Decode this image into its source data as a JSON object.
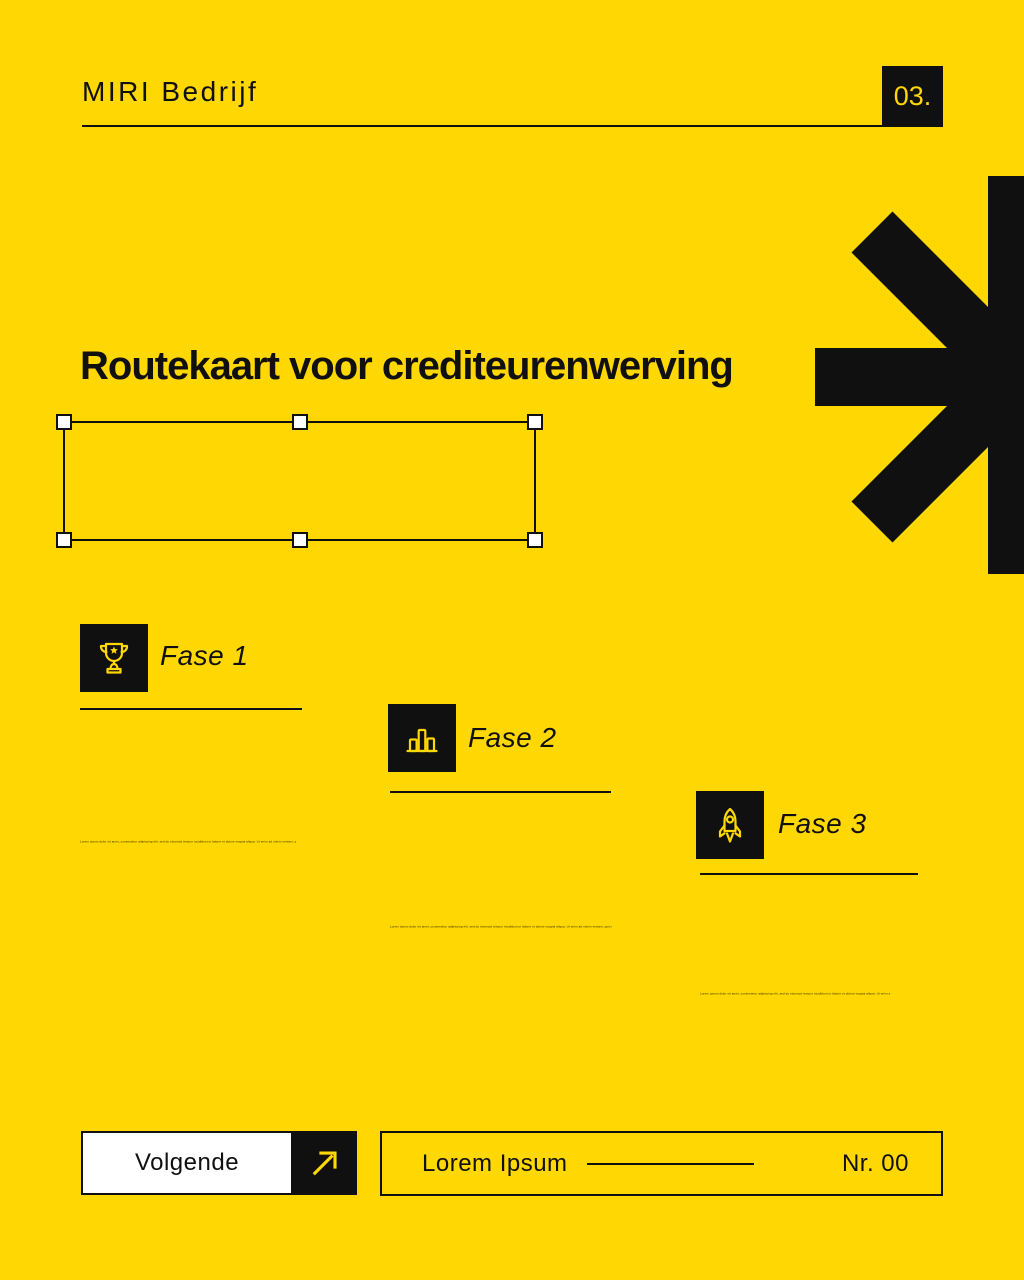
{
  "colors": {
    "background": "#FFD702",
    "ink": "#101010",
    "accent": "#FFD702",
    "handle_fill": "#FFFFFF"
  },
  "header": {
    "brand": "MIRI Bedrijf",
    "page_number": "03.",
    "decoration_icon": "half-asterisk-icon"
  },
  "title": "Routekaart voor crediteurenwerving",
  "phases": [
    {
      "label": "Fase 1",
      "icon": "trophy-icon",
      "description": "Lorem ipsum dolor sit amet, consectetur adipiscing elit, sed do eiusmod tempor incididunt ut labore et dolore magna aliqua. Ut enim ad minim veniam, quis nostrud exercitation ullamco laboris nisi ut aliquip."
    },
    {
      "label": "Fase 2",
      "icon": "bar-chart-icon",
      "description": "Lorem ipsum dolor sit amet, consectetur adipiscing elit, sed do eiusmod tempor incididunt ut labore et dolore magna aliqua. Ut enim ad minim veniam, quis nostrud exercitation ullamco laboris nisi ut aliquip."
    },
    {
      "label": "Fase 3",
      "icon": "rocket-icon",
      "description": "Lorem ipsum dolor sit amet, consectetur adipiscing elit, sed do eiusmod tempor incididunt ut labore et dolore magna aliqua. Ut enim ad minim veniam, quis nostrud exercitation."
    }
  ],
  "footer": {
    "next_label": "Volgende",
    "next_icon": "arrow-up-right-icon",
    "reference_label": "Lorem Ipsum",
    "number_label": "Nr. 00"
  }
}
